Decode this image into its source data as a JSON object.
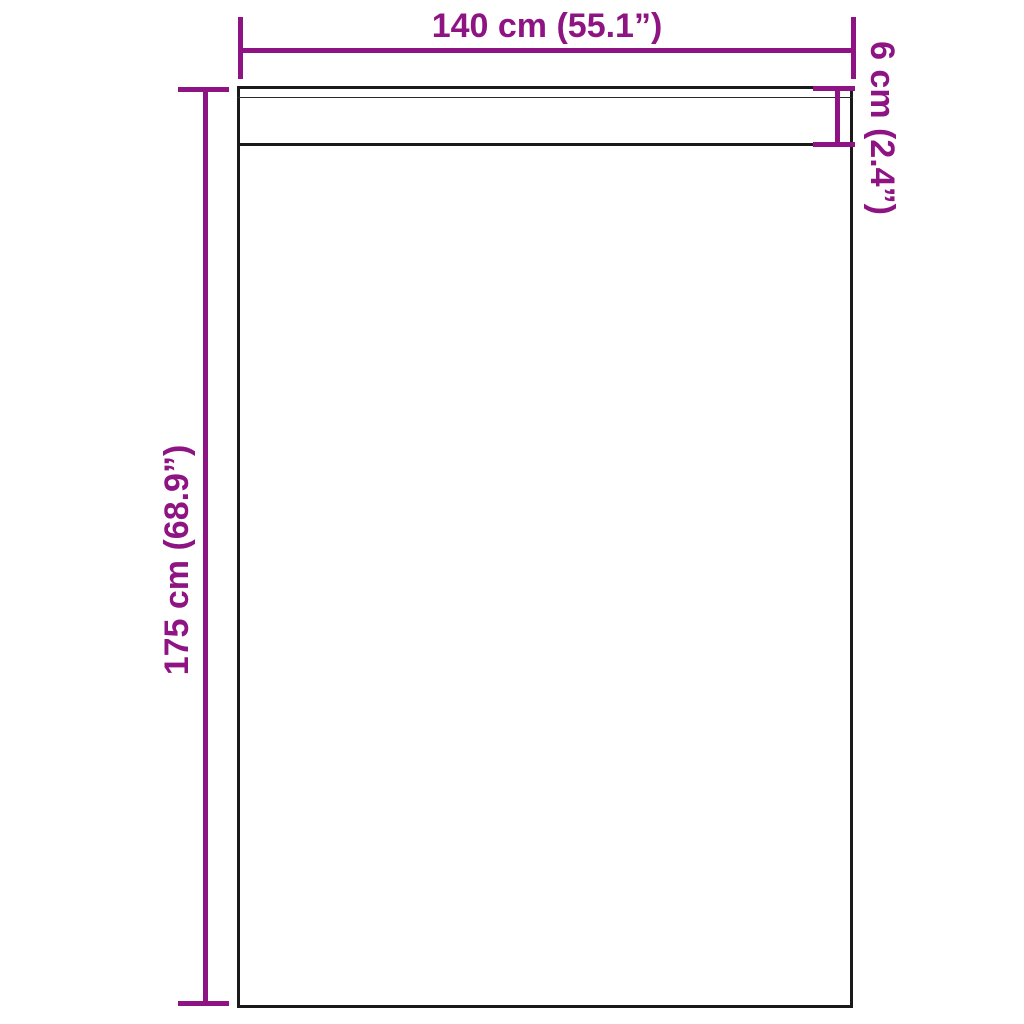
{
  "diagram": {
    "type": "product-dimension-diagram",
    "subject": "curtain-panel-with-header-strip",
    "labels": {
      "width": "140 cm (55.1”)",
      "height": "175 cm (68.9”)",
      "header_height": "6 cm (2.4”)"
    },
    "colors": {
      "accent": "#8f1483",
      "outline": "#1a1a1a",
      "bg": "#ffffff"
    }
  }
}
